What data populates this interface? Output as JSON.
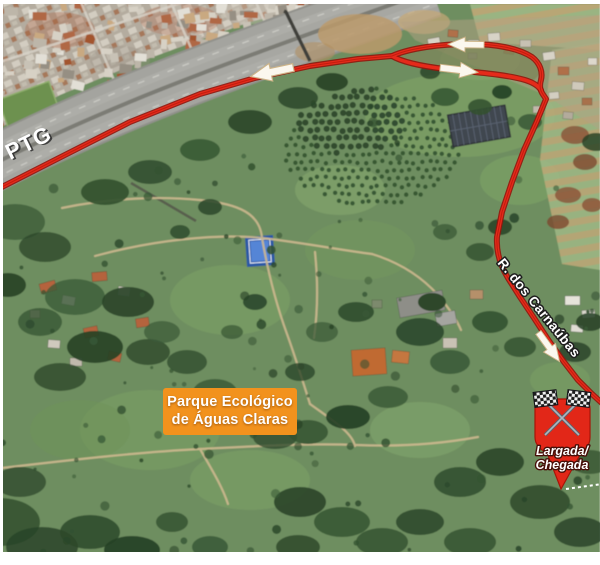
{
  "map": {
    "kind": "satellite-race-route-map",
    "highway_road_label": "PTG",
    "street_label": "R. dos Carnaúbas",
    "park_label": {
      "line1": "Parque Ecológico",
      "line2": "de Águas Claras",
      "bg_color": "#f2921d"
    },
    "start_finish_marker": {
      "line1": "Largada/",
      "line2": "Chegada",
      "pin_color": "#e22718",
      "icon": "checkered-flags-icon"
    },
    "route": {
      "color": "#e52a1a",
      "casing_color": "#94150c",
      "arrow_color": "#fbf7ee",
      "direction_arrows": [
        "left-on-highway",
        "left-on-loop-top",
        "right-on-loop-bottom",
        "down-right-on-street"
      ]
    }
  }
}
